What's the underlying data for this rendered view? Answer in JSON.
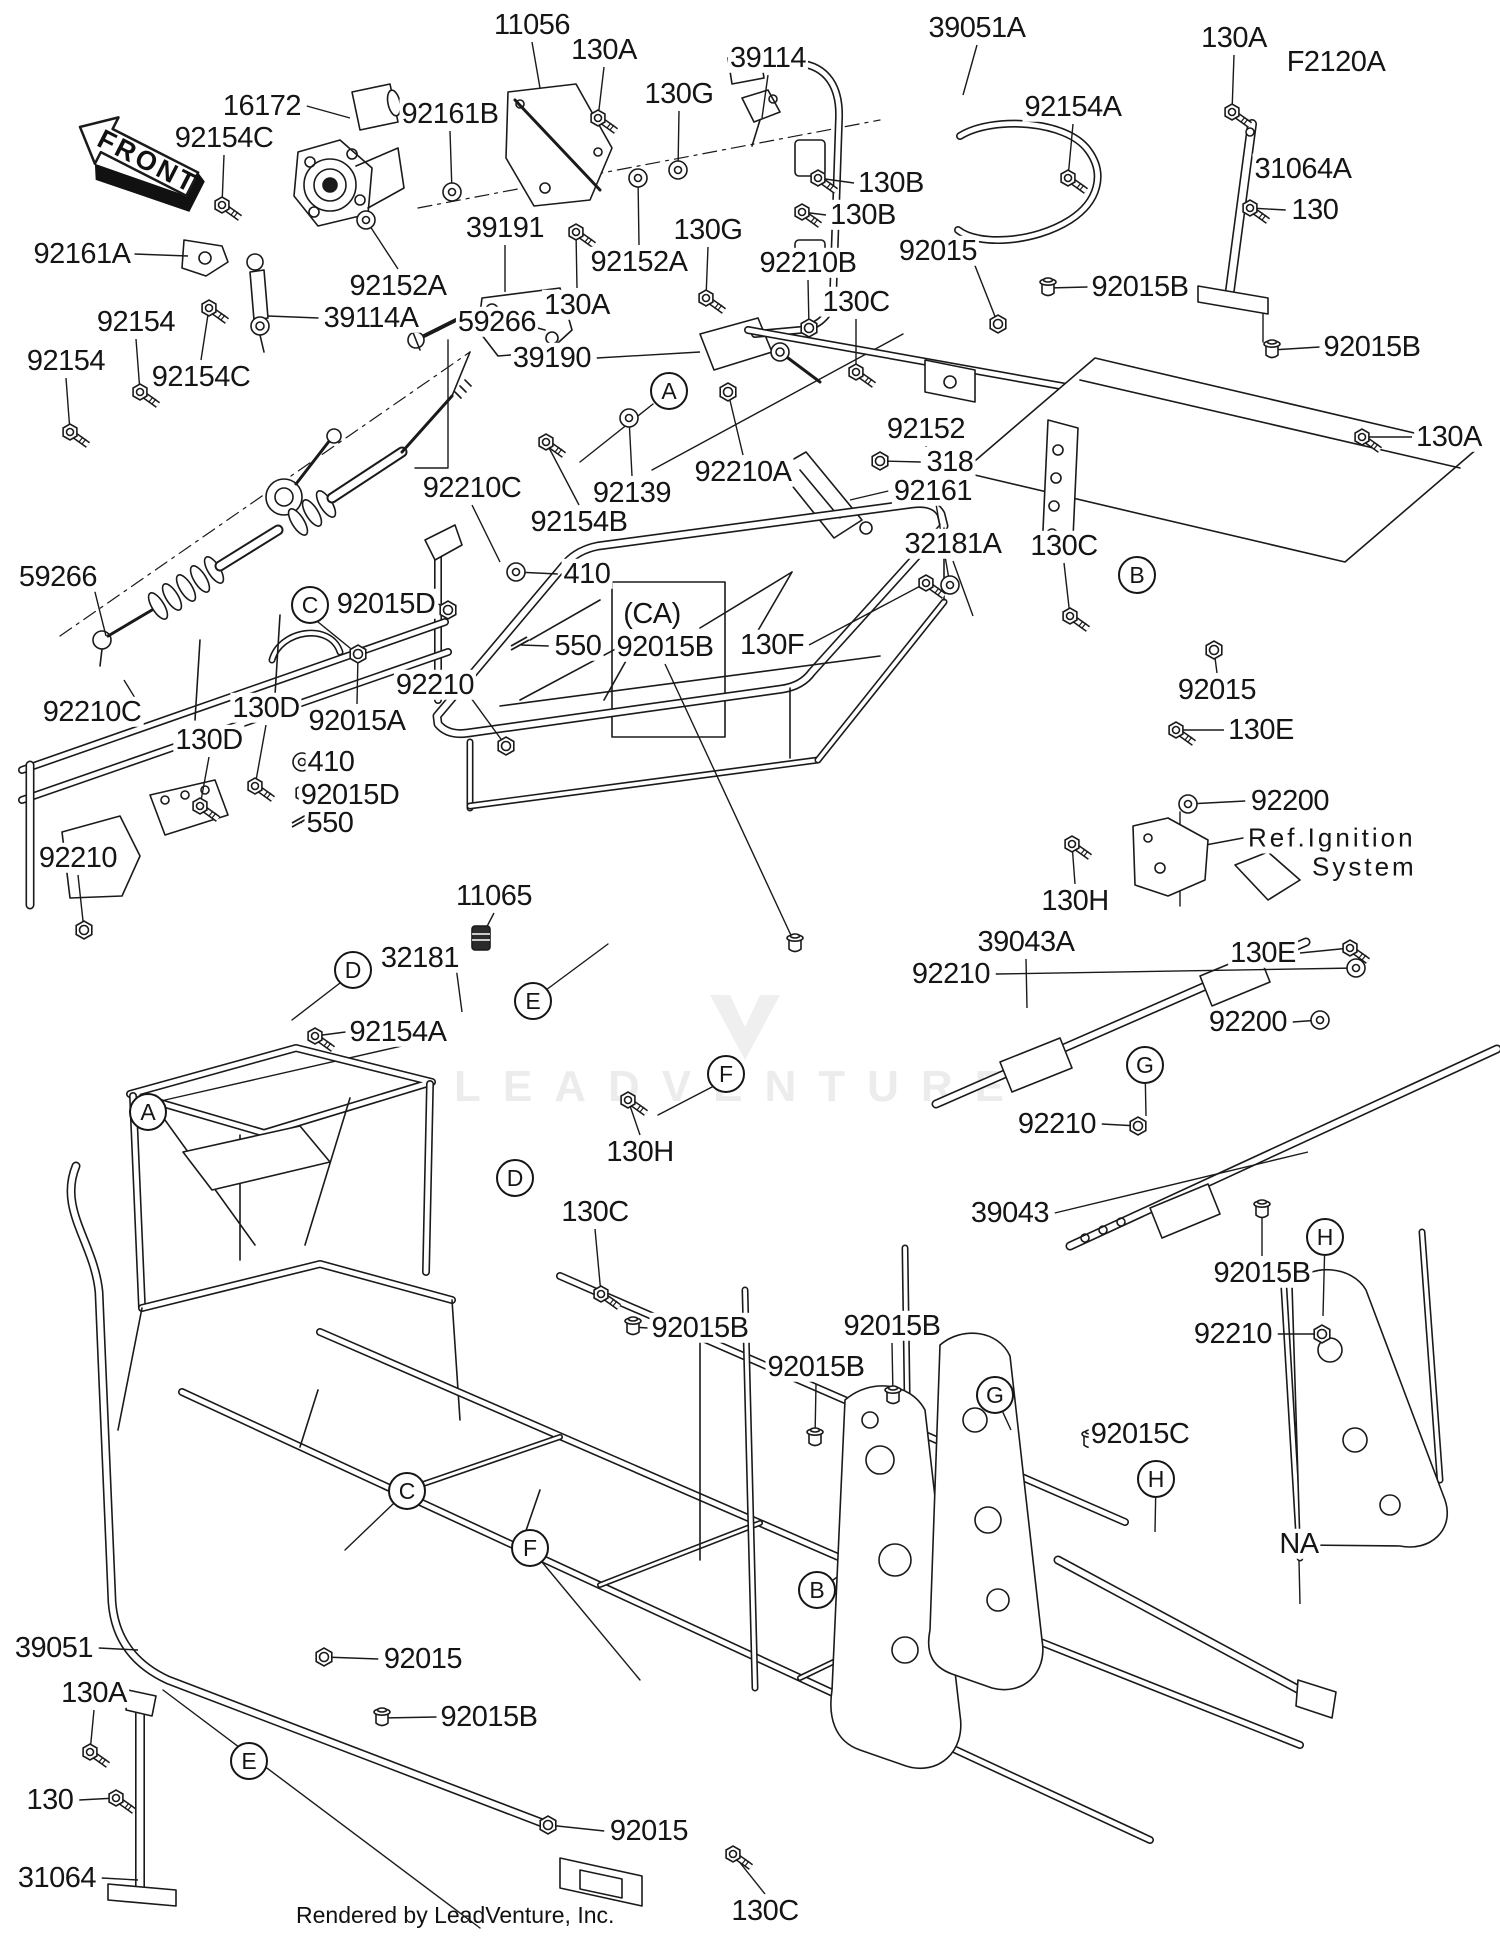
{
  "page": {
    "diagram_code": "F2120A",
    "front_marker": "FRONT",
    "footer": "Rendered by LeadVenture, Inc.",
    "watermark": "LEADVENTURE",
    "ref_note_line1": "Ref.Ignition",
    "ref_note_line2": "System",
    "colors": {
      "line": "#1a1a1a",
      "label_text": "#151515",
      "watermark": "#ececec",
      "background": "#ffffff"
    }
  },
  "labels": [
    {
      "t": "16172",
      "x": 262,
      "y": 106,
      "lx": 350,
      "ly": 118,
      "hw": "none"
    },
    {
      "t": "92154C",
      "x": 224,
      "y": 138,
      "lx": 222,
      "ly": 205,
      "hw": "bolt"
    },
    {
      "t": "92161B",
      "x": 450,
      "y": 114,
      "lx": 452,
      "ly": 192,
      "hw": "washer"
    },
    {
      "t": "11056",
      "x": 532,
      "y": 25,
      "lx": 540,
      "ly": 88,
      "hw": "none"
    },
    {
      "t": "130A",
      "x": 604,
      "y": 50,
      "lx": 598,
      "ly": 118,
      "hw": "bolt"
    },
    {
      "t": "130G",
      "x": 679,
      "y": 94,
      "lx": 678,
      "ly": 170,
      "hw": "washer"
    },
    {
      "t": "39114",
      "x": 768,
      "y": 58,
      "lx": 762,
      "ly": 118,
      "hw": "none"
    },
    {
      "t": "39051A",
      "x": 977,
      "y": 28,
      "lx": 963,
      "ly": 95,
      "hw": "none"
    },
    {
      "t": "130A",
      "x": 1234,
      "y": 38,
      "lx": 1232,
      "ly": 112,
      "hw": "bolt"
    },
    {
      "t": "F2120A",
      "x": 1336,
      "y": 62,
      "hw": "none"
    },
    {
      "t": "92154A",
      "x": 1073,
      "y": 107,
      "lx": 1068,
      "ly": 178,
      "hw": "bolt"
    },
    {
      "t": "31064A",
      "x": 1303,
      "y": 169,
      "lx": 1250,
      "ly": 168,
      "hw": "none"
    },
    {
      "t": "130",
      "x": 1315,
      "y": 210,
      "lx": 1250,
      "ly": 208,
      "hw": "bolt"
    },
    {
      "t": "92161A",
      "x": 82,
      "y": 254,
      "lx": 188,
      "ly": 256,
      "hw": "none"
    },
    {
      "t": "130B",
      "x": 891,
      "y": 183,
      "lx": 818,
      "ly": 178,
      "hw": "bolt"
    },
    {
      "t": "130B",
      "x": 863,
      "y": 215,
      "lx": 802,
      "ly": 212,
      "hw": "bolt"
    },
    {
      "t": "92152A",
      "x": 398,
      "y": 286,
      "lx": 366,
      "ly": 220,
      "hw": "washer"
    },
    {
      "t": "39191",
      "x": 505,
      "y": 228,
      "lx": 505,
      "ly": 292,
      "hw": "none"
    },
    {
      "t": "92152A",
      "x": 639,
      "y": 262,
      "lx": 638,
      "ly": 178,
      "hw": "washer"
    },
    {
      "t": "130G",
      "x": 708,
      "y": 230,
      "lx": 706,
      "ly": 298,
      "hw": "bolt"
    },
    {
      "t": "130A",
      "x": 577,
      "y": 305,
      "lx": 576,
      "ly": 232,
      "hw": "bolt"
    },
    {
      "t": "92210B",
      "x": 808,
      "y": 263,
      "lx": 809,
      "ly": 328,
      "hw": "nut"
    },
    {
      "t": "130C",
      "x": 856,
      "y": 302,
      "lx": 856,
      "ly": 372,
      "hw": "bolt"
    },
    {
      "t": "92015",
      "x": 938,
      "y": 251,
      "lx": 998,
      "ly": 324,
      "hw": "nut"
    },
    {
      "t": "92015B",
      "x": 1140,
      "y": 287,
      "lx": 1048,
      "ly": 288,
      "hw": "plug"
    },
    {
      "t": "92015B",
      "x": 1372,
      "y": 347,
      "lx": 1272,
      "ly": 350,
      "hw": "plug"
    },
    {
      "t": "39114A",
      "x": 371,
      "y": 318,
      "lx": 268,
      "ly": 316,
      "hw": "none"
    },
    {
      "t": "92154",
      "x": 136,
      "y": 322,
      "lx": 140,
      "ly": 392,
      "hw": "bolt"
    },
    {
      "t": "92154",
      "x": 66,
      "y": 361,
      "lx": 70,
      "ly": 432,
      "hw": "bolt"
    },
    {
      "t": "92154C",
      "x": 201,
      "y": 377,
      "lx": 209,
      "ly": 308,
      "hw": "bolt"
    },
    {
      "t": "59266",
      "x": 497,
      "y": 322,
      "lx": 437,
      "ly": 331,
      "hw": "none"
    },
    {
      "t": "130A",
      "x": 1449,
      "y": 437,
      "lx": 1362,
      "ly": 437,
      "hw": "bolt"
    },
    {
      "t": "318",
      "x": 950,
      "y": 462,
      "lx": 880,
      "ly": 461,
      "hw": "nut"
    },
    {
      "t": "92161",
      "x": 933,
      "y": 491,
      "lx": 850,
      "ly": 500,
      "hw": "none"
    },
    {
      "t": "92152",
      "x": 926,
      "y": 429,
      "lx": 950,
      "ly": 585,
      "hw": "washer"
    },
    {
      "t": "39190",
      "x": 552,
      "y": 358,
      "lx": 700,
      "ly": 352,
      "hw": "none"
    },
    {
      "t": "92210A",
      "x": 743,
      "y": 472,
      "lx": 728,
      "ly": 392,
      "hw": "nut"
    },
    {
      "t": "92139",
      "x": 632,
      "y": 493,
      "lx": 629,
      "ly": 418,
      "hw": "washer"
    },
    {
      "t": "92154B",
      "x": 579,
      "y": 522,
      "lx": 546,
      "ly": 442,
      "hw": "bolt"
    },
    {
      "t": "92210C",
      "x": 472,
      "y": 488,
      "lx": 500,
      "ly": 562,
      "hw": "none"
    },
    {
      "t": "410",
      "x": 587,
      "y": 574,
      "lx": 516,
      "ly": 572,
      "hw": "washer"
    },
    {
      "t": "92015D",
      "x": 386,
      "y": 604,
      "lx": 448,
      "ly": 610,
      "hw": "nut"
    },
    {
      "t": "550",
      "x": 578,
      "y": 646,
      "lx": 521,
      "ly": 645,
      "hw": "pin"
    },
    {
      "t": "59266",
      "x": 58,
      "y": 577,
      "lx": 106,
      "ly": 636,
      "hw": "none"
    },
    {
      "t": "92210C",
      "x": 92,
      "y": 712,
      "lx": 124,
      "ly": 680,
      "hw": "none"
    },
    {
      "t": "410",
      "x": 331,
      "y": 762,
      "lx": 302,
      "ly": 762,
      "hw": "washer"
    },
    {
      "t": "92015D",
      "x": 350,
      "y": 795,
      "lx": 304,
      "ly": 793,
      "hw": "nut"
    },
    {
      "t": "550",
      "x": 330,
      "y": 823,
      "lx": 302,
      "ly": 822,
      "hw": "pin"
    },
    {
      "t": "92210",
      "x": 78,
      "y": 858,
      "lx": 84,
      "ly": 930,
      "hw": "nut"
    },
    {
      "t": "130D",
      "x": 209,
      "y": 740,
      "lx": 200,
      "ly": 806,
      "hw": "bolt"
    },
    {
      "t": "130D",
      "x": 266,
      "y": 708,
      "lx": 255,
      "ly": 786,
      "hw": "bolt"
    },
    {
      "t": "92015A",
      "x": 357,
      "y": 721,
      "lx": 358,
      "ly": 654,
      "hw": "nut"
    },
    {
      "t": "92210",
      "x": 435,
      "y": 685,
      "lx": 506,
      "ly": 746,
      "hw": "nut"
    },
    {
      "t": "(CA)",
      "x": 652,
      "y": 614,
      "hw": "none"
    },
    {
      "t": "92015B",
      "x": 665,
      "y": 647,
      "lx": 795,
      "ly": 944,
      "hw": "plug"
    },
    {
      "t": "130F",
      "x": 772,
      "y": 645,
      "lx": 926,
      "ly": 583,
      "hw": "bolt"
    },
    {
      "t": "32181A",
      "x": 953,
      "y": 544,
      "lx": 973,
      "ly": 616,
      "hw": "none"
    },
    {
      "t": "130C",
      "x": 1064,
      "y": 546,
      "lx": 1070,
      "ly": 616,
      "hw": "bolt"
    },
    {
      "t": "92015",
      "x": 1217,
      "y": 690,
      "lx": 1214,
      "ly": 650,
      "hw": "nut"
    },
    {
      "t": "130E",
      "x": 1261,
      "y": 730,
      "lx": 1176,
      "ly": 730,
      "hw": "bolt"
    },
    {
      "t": "92200",
      "x": 1290,
      "y": 801,
      "lx": 1188,
      "ly": 804,
      "hw": "washer"
    },
    {
      "t": "130H",
      "x": 1075,
      "y": 901,
      "lx": 1072,
      "ly": 844,
      "hw": "bolt"
    },
    {
      "t": "39043A",
      "x": 1026,
      "y": 942,
      "lx": 1027,
      "ly": 1008,
      "hw": "none"
    },
    {
      "t": "92210",
      "x": 951,
      "y": 974,
      "lx": 1356,
      "ly": 968,
      "hw": "washer"
    },
    {
      "t": "130E",
      "x": 1263,
      "y": 953,
      "lx": 1350,
      "ly": 948,
      "hw": "bolt"
    },
    {
      "t": "92200",
      "x": 1248,
      "y": 1022,
      "lx": 1320,
      "ly": 1020,
      "hw": "washer"
    },
    {
      "t": "92210",
      "x": 1057,
      "y": 1124,
      "lx": 1138,
      "ly": 1126,
      "hw": "nut"
    },
    {
      "t": "39043",
      "x": 1010,
      "y": 1213,
      "lx": 1308,
      "ly": 1152,
      "hw": "none"
    },
    {
      "t": "92015B",
      "x": 1262,
      "y": 1273,
      "lx": 1262,
      "ly": 1210,
      "hw": "plug"
    },
    {
      "t": "92210",
      "x": 1233,
      "y": 1334,
      "lx": 1322,
      "ly": 1334,
      "hw": "nut"
    },
    {
      "t": "92154A",
      "x": 398,
      "y": 1032,
      "lx": 315,
      "ly": 1036,
      "hw": "bolt"
    },
    {
      "t": "32181",
      "x": 420,
      "y": 958,
      "lx": 462,
      "ly": 1012,
      "hw": "none"
    },
    {
      "t": "11065",
      "x": 494,
      "y": 896,
      "lx": 481,
      "ly": 938,
      "hw": "cap"
    },
    {
      "t": "130H",
      "x": 640,
      "y": 1152,
      "lx": 628,
      "ly": 1100,
      "hw": "bolt"
    },
    {
      "t": "130C",
      "x": 595,
      "y": 1212,
      "lx": 601,
      "ly": 1294,
      "hw": "bolt"
    },
    {
      "t": "92015B",
      "x": 700,
      "y": 1328,
      "lx": 633,
      "ly": 1327,
      "hw": "plug"
    },
    {
      "t": "92015B",
      "x": 892,
      "y": 1326,
      "lx": 893,
      "ly": 1396,
      "hw": "plug"
    },
    {
      "t": "92015B",
      "x": 816,
      "y": 1367,
      "lx": 815,
      "ly": 1438,
      "hw": "plug"
    },
    {
      "t": "92015C",
      "x": 1140,
      "y": 1434,
      "lx": 1090,
      "ly": 1440,
      "hw": "plug"
    },
    {
      "t": "NA",
      "x": 1299,
      "y": 1544,
      "lx": 1300,
      "ly": 1604,
      "hw": "none"
    },
    {
      "t": "39051",
      "x": 54,
      "y": 1648,
      "lx": 138,
      "ly": 1650,
      "hw": "none"
    },
    {
      "t": "130A",
      "x": 94,
      "y": 1693,
      "lx": 90,
      "ly": 1752,
      "hw": "bolt"
    },
    {
      "t": "130",
      "x": 50,
      "y": 1800,
      "lx": 116,
      "ly": 1798,
      "hw": "bolt"
    },
    {
      "t": "31064",
      "x": 57,
      "y": 1878,
      "lx": 138,
      "ly": 1880,
      "hw": "none"
    },
    {
      "t": "92015",
      "x": 423,
      "y": 1659,
      "lx": 324,
      "ly": 1657,
      "hw": "nut"
    },
    {
      "t": "92015B",
      "x": 489,
      "y": 1717,
      "lx": 382,
      "ly": 1718,
      "hw": "plug"
    },
    {
      "t": "92015",
      "x": 649,
      "y": 1831,
      "lx": 548,
      "ly": 1825,
      "hw": "nut"
    },
    {
      "t": "130C",
      "x": 765,
      "y": 1911,
      "lx": 733,
      "ly": 1854,
      "hw": "bolt"
    }
  ],
  "callouts": [
    {
      "letter": "A",
      "x": 669,
      "y": 391
    },
    {
      "letter": "A",
      "x": 148,
      "y": 1112
    },
    {
      "letter": "B",
      "x": 1137,
      "y": 575
    },
    {
      "letter": "B",
      "x": 817,
      "y": 1590
    },
    {
      "letter": "C",
      "x": 310,
      "y": 605
    },
    {
      "letter": "C",
      "x": 407,
      "y": 1491
    },
    {
      "letter": "D",
      "x": 353,
      "y": 970
    },
    {
      "letter": "D",
      "x": 515,
      "y": 1178
    },
    {
      "letter": "E",
      "x": 533,
      "y": 1001
    },
    {
      "letter": "E",
      "x": 249,
      "y": 1761
    },
    {
      "letter": "F",
      "x": 726,
      "y": 1074
    },
    {
      "letter": "F",
      "x": 530,
      "y": 1548
    },
    {
      "letter": "G",
      "x": 1145,
      "y": 1065,
      "lx": 1146,
      "ly": 1116
    },
    {
      "letter": "G",
      "x": 995,
      "y": 1395,
      "lx": 1011,
      "ly": 1430
    },
    {
      "letter": "H",
      "x": 1325,
      "y": 1237,
      "lx": 1323,
      "ly": 1316
    },
    {
      "letter": "H",
      "x": 1156,
      "y": 1479,
      "lx": 1155,
      "ly": 1532
    }
  ]
}
